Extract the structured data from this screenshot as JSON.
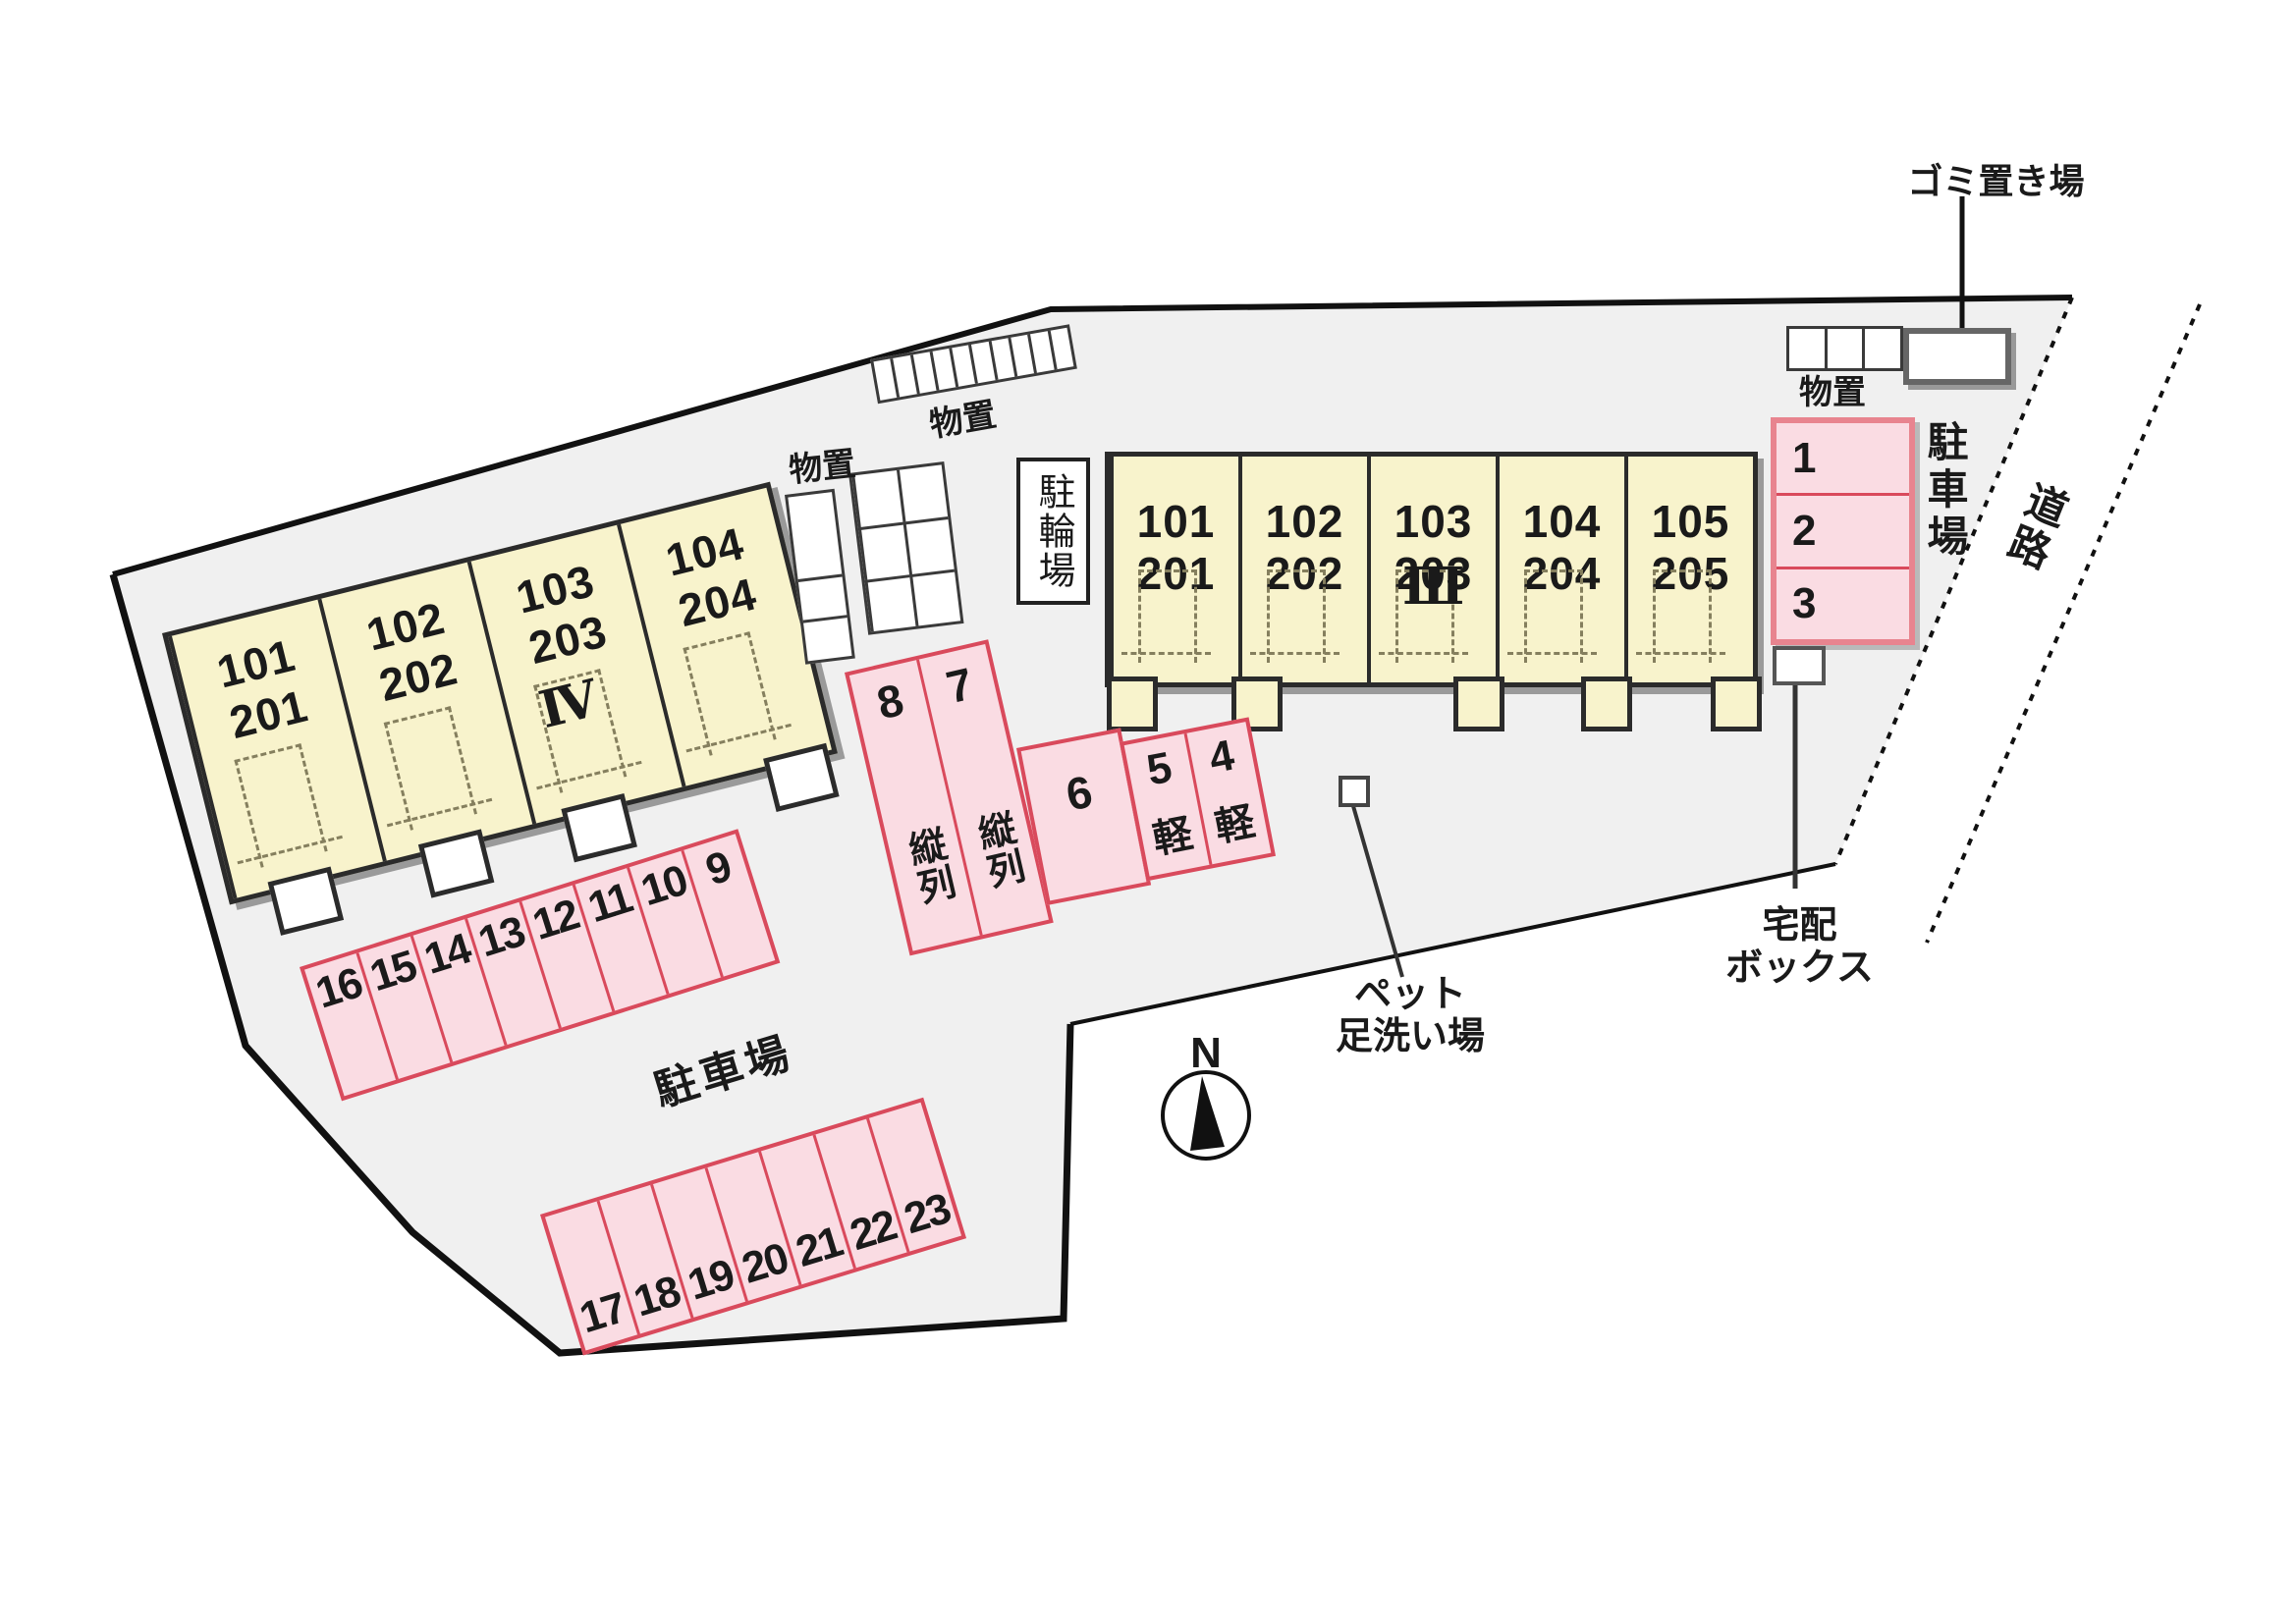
{
  "diagram": {
    "title": "site-plan",
    "compass_label": "N",
    "road_label": "道路",
    "garbage_label": "ゴミ置き場",
    "storage_label": "物置",
    "bicycle_label": "駐輪場",
    "parking_lot_label": "駐車場",
    "delivery_label_line1": "宅配",
    "delivery_label_line2": "ボックス",
    "pet_label_line1": "ペット",
    "pet_label_line2": "足洗い場",
    "tandem_label": "縦列",
    "kei_label": "軽",
    "buildings": {
      "iii": {
        "numeral": "Ⅲ",
        "units": [
          [
            "101",
            "201"
          ],
          [
            "102",
            "202"
          ],
          [
            "103",
            "203"
          ],
          [
            "104",
            "204"
          ],
          [
            "105",
            "205"
          ]
        ]
      },
      "iv": {
        "numeral": "Ⅳ",
        "units": [
          [
            "101",
            "201"
          ],
          [
            "102",
            "202"
          ],
          [
            "103",
            "203"
          ],
          [
            "104",
            "204"
          ]
        ]
      }
    },
    "parking": {
      "block_right": [
        "1",
        "2",
        "3"
      ],
      "tandem": [
        "8",
        "7"
      ],
      "single": "6",
      "kei": [
        "5",
        "4"
      ],
      "row_upper": [
        "16",
        "15",
        "14",
        "13",
        "12",
        "11",
        "10",
        "9"
      ],
      "row_lower": [
        "17",
        "18",
        "19",
        "20",
        "21",
        "22",
        "23"
      ]
    },
    "colors": {
      "site_fill": "#f0f0f0",
      "building_fill": "#f8f3cc",
      "parking_fill": "#fadce3",
      "parking_border": "#d94a5c",
      "outline": "#2b2b2b"
    }
  }
}
